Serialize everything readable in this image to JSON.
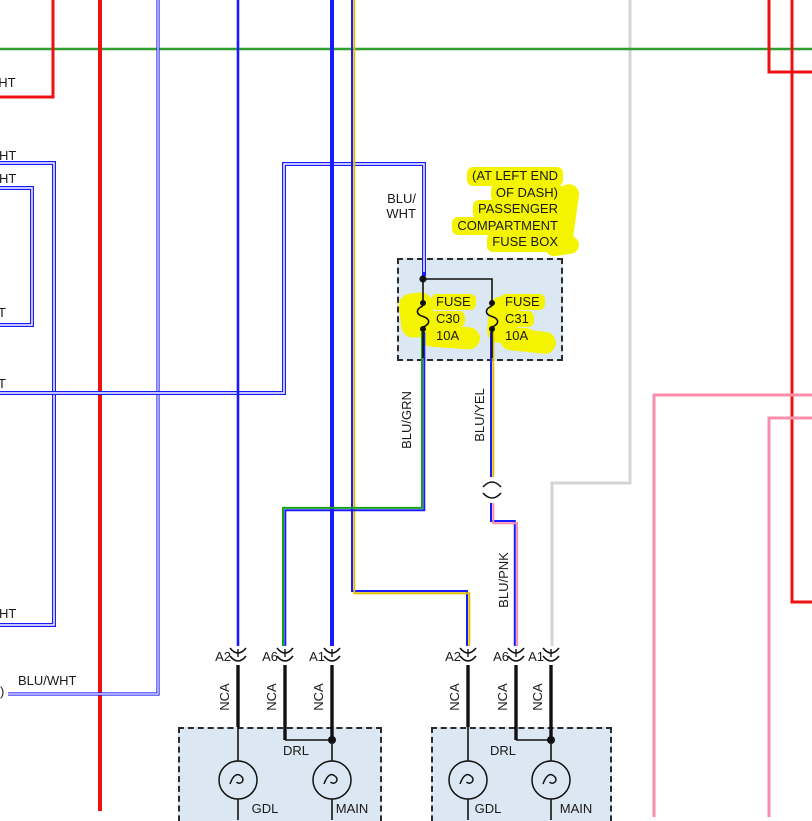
{
  "colors": {
    "wire_blue": "#1a1aff",
    "wire_red": "#ee1111",
    "wire_green_bus": "#2f9e2f",
    "wire_pink": "#fb8daa",
    "wire_gray": "#d4d4d4",
    "wire_yellow": "#e0bf00",
    "wire_grn_stripe": "#17a317",
    "highlight": "#f4f400",
    "box_fill": "#dbe8f3"
  },
  "edge_labels": {
    "red_top_fragment": "WHT",
    "wht_fragment_1": "HT",
    "wht_fragment_2": "HT",
    "t_fragment_1": "T",
    "t_fragment_2": "T",
    "wht_fragment_3": "HT",
    "blu_wht": "BLU/WHT",
    "offpage_mark": ")"
  },
  "feed_label": {
    "line1": "BLU/",
    "line2": "WHT"
  },
  "fusebox": {
    "callout_line1": "(AT LEFT END",
    "callout_line2": "OF DASH)",
    "callout_line3": "PASSENGER",
    "callout_line4": "COMPARTMENT",
    "callout_line5": "FUSE BOX",
    "fuse1": {
      "name": "FUSE",
      "code": "C30",
      "amps": "10A"
    },
    "fuse2": {
      "name": "FUSE",
      "code": "C31",
      "amps": "10A"
    }
  },
  "wire_labels": {
    "blu_grn": "BLU/GRN",
    "blu_yel": "BLU/YEL",
    "blu_pnk": "BLU/PNK"
  },
  "lamp_left": {
    "pin_a2": "A2",
    "pin_a6": "A6",
    "pin_a1": "A1",
    "nca_1": "NCA",
    "nca_2": "NCA",
    "nca_3": "NCA",
    "drl": "DRL",
    "bulb_gdl": "GDL",
    "bulb_main": "MAIN"
  },
  "lamp_right": {
    "pin_a2": "A2",
    "pin_a6": "A6",
    "pin_a1": "A1",
    "nca_1": "NCA",
    "nca_2": "NCA",
    "nca_3": "NCA",
    "drl": "DRL",
    "bulb_gdl": "GDL",
    "bulb_main": "MAIN"
  }
}
